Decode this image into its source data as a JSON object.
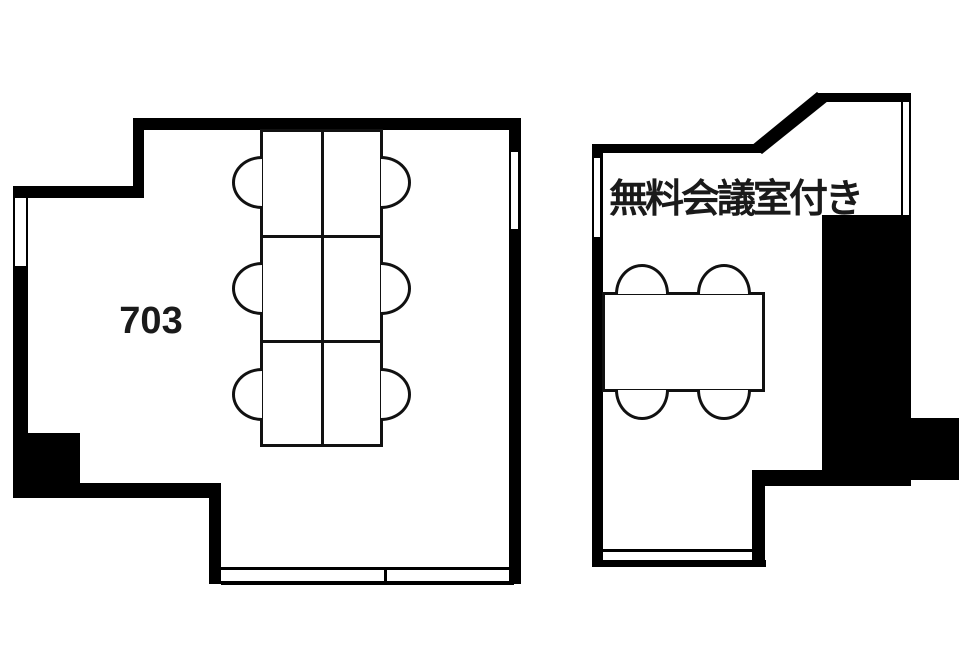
{
  "page": {
    "background": "#ffffff"
  },
  "floor_plan": {
    "wall_color": "#000000",
    "furniture_line_color": "#111111",
    "text_color": "#1a1a1a",
    "rooms": [
      {
        "id": "office-703",
        "label": "703",
        "furniture": {
          "desk_layout": "2x3 desk cluster",
          "desks": 6,
          "chairs": 6,
          "windows": 3
        }
      },
      {
        "id": "meeting-room",
        "label": "無料会議室付き",
        "furniture": {
          "tables": 1,
          "chairs": 4,
          "windows": 3
        }
      }
    ]
  }
}
